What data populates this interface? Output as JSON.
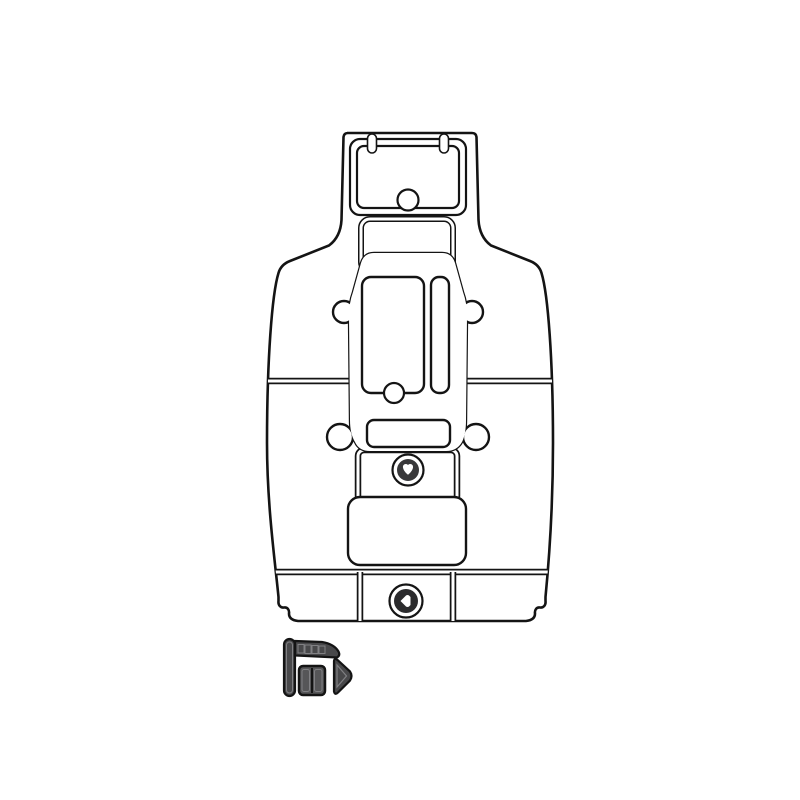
{
  "page": {
    "background_color": "#ffffff"
  },
  "product": {
    "colors": {
      "page_bg": "#ffffff",
      "mat_base": "#48484a",
      "stripe": "#28282a",
      "outline": "#141414",
      "seam_white": "#ffffff",
      "medallion_ring": "#ffffff",
      "medallion_disc_top": "#38383a",
      "medallion_disc_bottom": "#2b2b2d",
      "glyph_white": "#ffffff",
      "accessory_pad": "#565658",
      "detail_gray": "#808083"
    },
    "icons": {
      "medallion_top": "brand-logo-medallion-icon",
      "medallion_bottom": "brand-logo-medallion-icon"
    }
  }
}
